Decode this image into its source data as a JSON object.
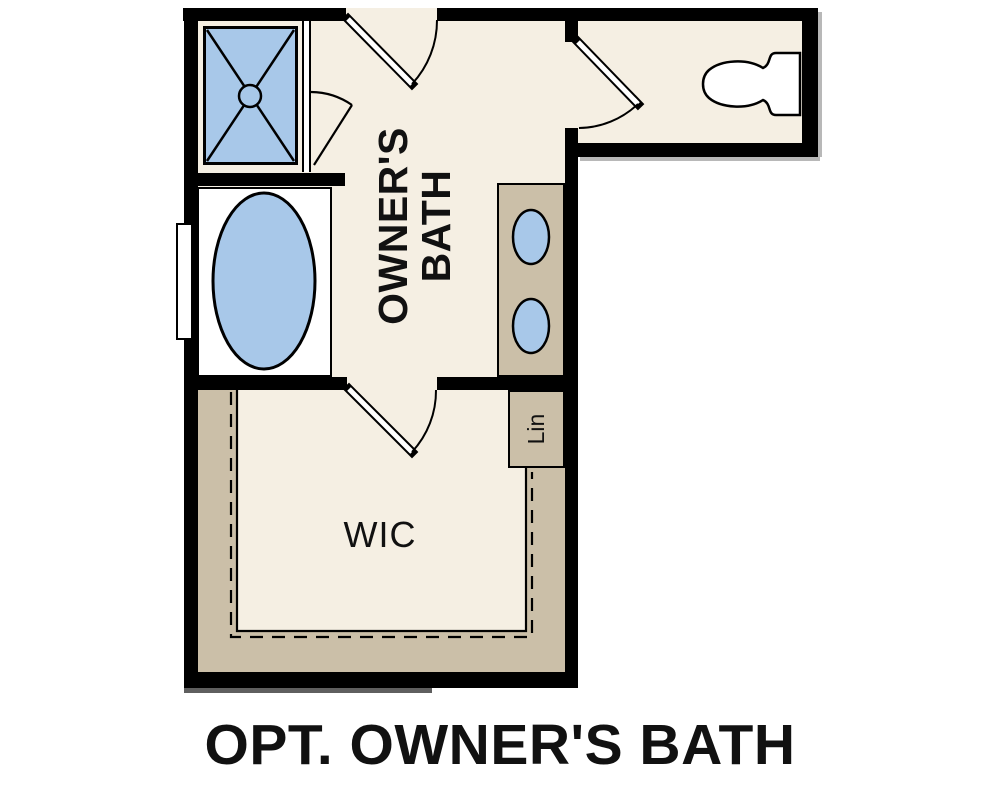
{
  "plan": {
    "caption": "OPT. OWNER'S BATH",
    "rooms": {
      "owners_bath": {
        "label_line1": "OWNER'S",
        "label_line2": "BATH"
      },
      "walk_in_closet": {
        "label": "WIC"
      },
      "linen_closet": {
        "label": "Lin"
      }
    },
    "fixtures": [
      "shower",
      "bathtub",
      "double-sink-vanity",
      "toilet",
      "window",
      "closet-shelving",
      "door-swings"
    ]
  },
  "colors": {
    "floor": "#f5efe3",
    "cabinet": "#cbbfa8",
    "fixture": "#a8c8e9",
    "wall": "#000000",
    "line": "#000000",
    "text": "#111111",
    "background": "#ffffff"
  }
}
